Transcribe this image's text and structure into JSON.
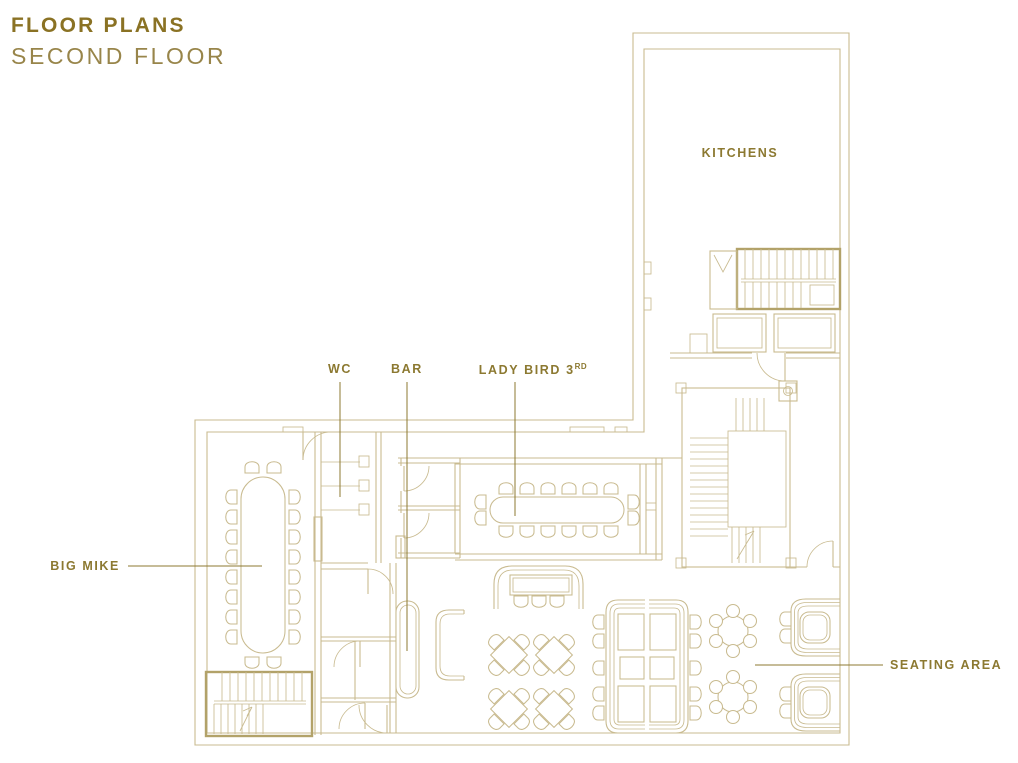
{
  "title": {
    "line1": "FLOOR PLANS",
    "line2": "SECOND FLOOR"
  },
  "rooms": {
    "kitchens": {
      "label": "KITCHENS"
    },
    "wc": {
      "label": "WC"
    },
    "bar": {
      "label": "BAR"
    },
    "lady_bird": {
      "label": "LADY BIRD 3",
      "ordinal": "RD"
    },
    "big_mike": {
      "label": "BIG MIKE"
    },
    "seating_area": {
      "label": "SEATING AREA"
    }
  },
  "colors": {
    "background": "#ffffff",
    "wall_line": "#c9bb90",
    "wall_dark": "#b2a269",
    "label_text": "#8c7931",
    "title_bold": "#8a7224",
    "title_light": "#98854a",
    "leader_line": "#8c7931"
  }
}
